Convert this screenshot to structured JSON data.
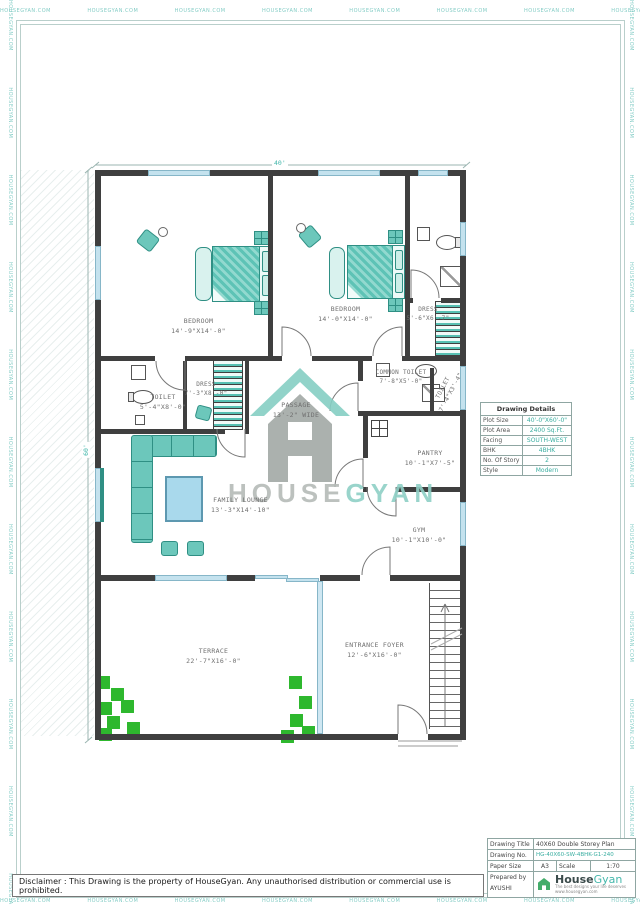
{
  "colors": {
    "accent": "#45b8ac",
    "wall": "#3f3f3f",
    "glass_blue": "#c4e2ee",
    "furniture_teal": "#6cc7bb",
    "plant_green": "#2eb82e",
    "watermark_gray": "#b5bbb8"
  },
  "page": {
    "border_watermark": "HOUSEGYAN.COM"
  },
  "watermark": {
    "house": "HOUSE",
    "gyan": "GYAN"
  },
  "plan": {
    "dim_width": "40'",
    "dim_height": "60'",
    "rooms": [
      {
        "name": "BEDROOM",
        "size": "14'-9\"X14'-0\""
      },
      {
        "name": "BEDROOM",
        "size": "14'-0\"X14'-0\""
      },
      {
        "name": "DRESS",
        "size": "5'-6\"X6'-7\""
      },
      {
        "name": "TOILET",
        "size": "5'-4\"X8'-0\""
      },
      {
        "name": "DRESS",
        "size": "7'-3\"X8'-0\""
      },
      {
        "name": "PASSAGE",
        "size": "13'-2\" WIDE"
      },
      {
        "name": "COMMON TOILET",
        "size": "7'-8\"X5'-0\""
      },
      {
        "name": "TOILET",
        "size": "7'-4\"X3'-4\""
      },
      {
        "name": "PANTRY",
        "size": "10'-1\"X7'-5\""
      },
      {
        "name": "FAMILY LOUNGE",
        "size": "13'-3\"X14'-10\""
      },
      {
        "name": "GYM",
        "size": "10'-1\"X10'-0\""
      },
      {
        "name": "TERRACE",
        "size": "22'-7\"X16'-0\""
      },
      {
        "name": "ENTRANCE FOYER",
        "size": "12'-6\"X16'-0\""
      }
    ]
  },
  "details_table": {
    "title": "Drawing Details",
    "rows": [
      {
        "label": "Plot Size",
        "value": "40'-0\"X60'-0\""
      },
      {
        "label": "Plot Area",
        "value": "2400 Sq.Ft."
      },
      {
        "label": "Facing",
        "value": "SOUTH-WEST"
      },
      {
        "label": "BHK",
        "value": "4BHK"
      },
      {
        "label": "No. Of Story",
        "value": "2"
      },
      {
        "label": "Style",
        "value": "Modern"
      }
    ]
  },
  "title_block": {
    "drawing_title_label": "Drawing Title",
    "drawing_title": "40X60 Double Storey Plan",
    "drawing_no_label": "Drawing No.",
    "drawing_no": "HG-40X60-SW-4BHK-G1-240",
    "paper_size_label": "Paper Size",
    "paper_size": "A3",
    "scale_label": "Scale",
    "scale": "1:70",
    "prepared_by_label": "Prepared by",
    "prepared_by": "AYUSHI",
    "logo_house": "House",
    "logo_gyan": "Gyan",
    "logo_tagline": "The best designs your life deserves",
    "logo_site": "www.housegyan.com"
  },
  "disclaimer": "Disclaimer : This Drawing is the property of HouseGyan. Any unauthorised distribution or commercial use is prohibited."
}
